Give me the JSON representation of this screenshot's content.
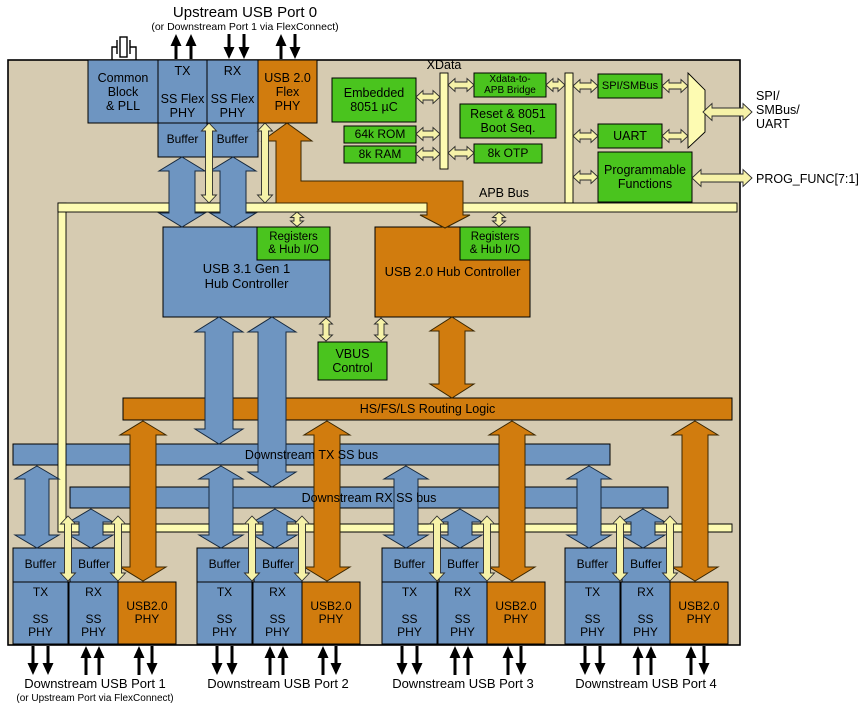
{
  "colors": {
    "chip_background": "#d6cbb1",
    "block_blue": "#6e95c1",
    "block_orange": "#d17c0e",
    "block_green": "#4ac41e",
    "bus_yellow": "#fdfbb2",
    "arrow_yellow": "#f6f2a8"
  },
  "upstream_port": {
    "title": "Upstream USB Port 0",
    "subtitle": "(or Downstream Port 1 via FlexConnect)"
  },
  "upstream_phy": {
    "common_block": "Common\nBlock\n& PLL",
    "tx_phy": "TX\n\nSS Flex\nPHY",
    "rx_phy": "RX\n\nSS Flex\nPHY",
    "usb20_phy": "USB 2.0\nFlex\nPHY",
    "buffer_left": "Buffer",
    "buffer_right": "Buffer"
  },
  "mcu": {
    "embedded": "Embedded\n8051 µC",
    "rom": "64k ROM",
    "ram": "8k RAM",
    "xdata_bus": "XData",
    "bridge": "Xdata-to-\nAPB Bridge",
    "reset_boot": "Reset & 8051\nBoot Seq.",
    "otp": "8k OTP"
  },
  "peripherals": {
    "spi_smbus": "SPI/SMBus",
    "uart": "UART",
    "prog_functions": "Programmable\nFunctions"
  },
  "external_signals": {
    "spi_smbus_uart": "SPI/\nSMBus/\nUART",
    "prog_func": "PROG_FUNC[7:1]"
  },
  "buses": {
    "apb": "APB Bus",
    "routing_logic": "HS/FS/LS Routing Logic",
    "downstream_tx": "Downstream TX SS bus",
    "downstream_rx": "Downstream RX SS bus"
  },
  "hubs": {
    "usb31": "USB 3.1 Gen 1\nHub Controller",
    "usb31_registers": "Registers\n& Hub I/O",
    "usb20": "USB 2.0 Hub Controller",
    "usb20_registers": "Registers\n& Hub I/O",
    "vbus": "VBUS\nControl"
  },
  "ports": [
    {
      "label": "Downstream USB Port 1",
      "sublabel": "(or Upstream Port via FlexConnect)",
      "buffer_left": "Buffer",
      "buffer_right": "Buffer",
      "tx_phy": "TX\n\nSS\nPHY",
      "rx_phy": "RX\n\nSS\nPHY",
      "usb20_phy": "USB2.0\nPHY"
    },
    {
      "label": "Downstream USB Port 2",
      "buffer_left": "Buffer",
      "buffer_right": "Buffer",
      "tx_phy": "TX\n\nSS\nPHY",
      "rx_phy": "RX\n\nSS\nPHY",
      "usb20_phy": "USB2.0\nPHY"
    },
    {
      "label": "Downstream USB Port 3",
      "buffer_left": "Buffer",
      "buffer_right": "Buffer",
      "tx_phy": "TX\n\nSS\nPHY",
      "rx_phy": "RX\n\nSS\nPHY",
      "usb20_phy": "USB2.0\nPHY"
    },
    {
      "label": "Downstream USB Port 4",
      "buffer_left": "Buffer",
      "buffer_right": "Buffer",
      "tx_phy": "TX\n\nSS\nPHY",
      "rx_phy": "RX\n\nSS\nPHY",
      "usb20_phy": "USB2.0\nPHY"
    }
  ]
}
